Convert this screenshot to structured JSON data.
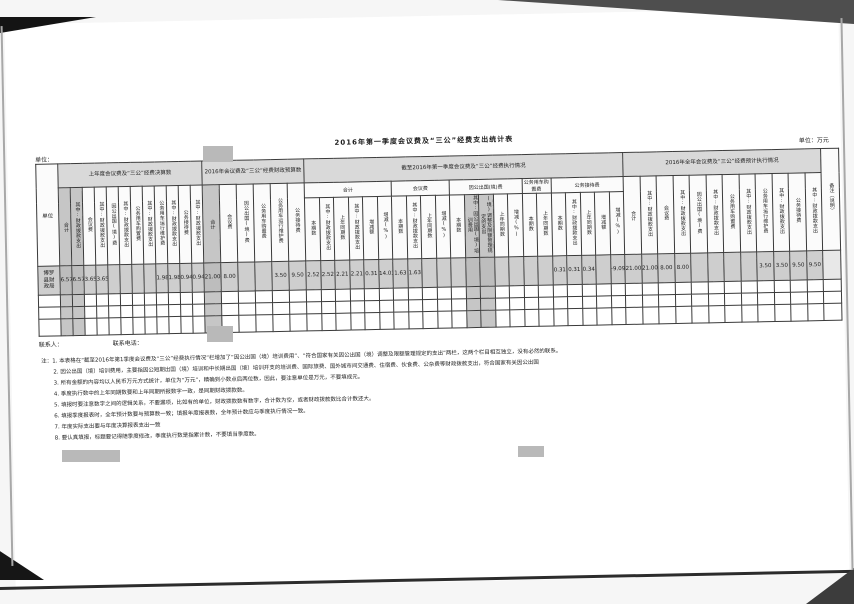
{
  "page": {
    "title": "2016年第一季度会议费及“三公”经费支出统计表",
    "unit_label": "单位：",
    "unit_of_measure": "单位：万元"
  },
  "table": {
    "unit_column_header": "单位",
    "remark_column_header": "备注（说明）",
    "row": {
      "unit_name": "博罗县财政局",
      "remark": ""
    },
    "groups": [
      {
        "title": "上年度会议费及“三公”经费决算数",
        "col_width": 12,
        "labels": [
          "合计",
          "其中:财政拨款支出",
          "会议费",
          "其中:财政拨款支出",
          "因公出国(境)费",
          "其中:财政拨款支出",
          "公务用车购置费",
          "其中:财政拨款支出",
          "公务用车运行维护费",
          "其中:财政拨款支出",
          "公务接待费",
          "其中:财政拨款支出"
        ],
        "shaded": [
          1,
          1,
          0,
          0,
          0,
          0,
          0,
          0,
          0,
          0,
          0,
          0
        ],
        "values": [
          "6.57",
          "6.57",
          "3.65",
          "3.65",
          "",
          "",
          "",
          "",
          "1.98",
          "1.98",
          "0.94",
          "0.94"
        ]
      },
      {
        "title": "2016年会议费及“三公”经费财政预算数",
        "col_width": 17,
        "labels": [
          "合计",
          "会议费",
          "因公出国(境)费",
          "公务用车购置费",
          "公务用车运行维护费",
          "公务接待费"
        ],
        "shaded": [
          1,
          0,
          0,
          0,
          0,
          0
        ],
        "values": [
          "21.00",
          "8.00",
          "",
          "",
          "3.50",
          "9.50"
        ]
      },
      {
        "title": "截至2016年第一季度会议费及“三公”经费执行情况",
        "col_width": 14.5,
        "categories": [
          {
            "label": "合计",
            "span": 6
          },
          {
            "label": "会议费",
            "span": 4
          },
          {
            "label": "因公出国(境)费",
            "span": 5
          },
          {
            "label": "公务用车购置费",
            "span": 2
          },
          {
            "label": "公务接待费",
            "span": 5
          }
        ],
        "labels": [
          "本期数",
          "其中:财政拨款支出",
          "上年同期数",
          "其中:财政拨款支出",
          "增减额",
          "增减(%)",
          "本期数",
          "其中:财政拨款支出",
          "上年同期数",
          "增减(%)",
          "本期数",
          "其中:因公出国(境)培训费用",
          "符合国家有关因公出国(境)调整及限额管理规定的支出",
          "上年同期数",
          "增减(%)",
          "本期数",
          "上年同期数",
          "本期数",
          "其中:财政拨款支出",
          "上年同期数",
          "增减额",
          "增减(%)"
        ],
        "shaded": [
          0,
          0,
          0,
          0,
          0,
          0,
          0,
          0,
          0,
          0,
          0,
          1,
          1,
          0,
          0,
          0,
          0,
          0,
          0,
          0,
          0,
          0
        ],
        "values": [
          "2.52",
          "2.52",
          "2.21",
          "2.21",
          "0.31",
          "14.03%",
          "1.63",
          "1.63",
          "",
          "",
          "",
          "",
          "",
          "",
          "",
          "",
          "",
          "0.31",
          "0.31",
          "0.34",
          "",
          "-9.09%"
        ]
      },
      {
        "title": "2016年全年会议费及“三公”经费预计执行情况",
        "col_width": 16.5,
        "labels": [
          "合计",
          "其中:财政拨款支出",
          "会议费",
          "其中:财政拨款支出",
          "因公出国(境)费",
          "其中:财政拨款支出",
          "公务用车购置费",
          "其中:财政拨款支出",
          "公务用车运行维护费",
          "其中:财政拨款支出",
          "公务接待费",
          "其中:财政拨款支出"
        ],
        "shaded": [
          0,
          0,
          0,
          0,
          0,
          0,
          0,
          0,
          0,
          0,
          0,
          0
        ],
        "values": [
          "21.00",
          "21.00",
          "8.00",
          "8.00",
          "",
          "",
          "",
          "",
          "3.50",
          "3.50",
          "9.50",
          "9.50"
        ]
      }
    ]
  },
  "contact": {
    "person_label": "联系人：",
    "phone_label": "联系电话："
  },
  "notes": [
    "注：1. 本表格在“截至2016年第1季度会议费及“三公”经费执行情况”栏增加了“因公出国（境）培训费用”、“符合国家有关因公出国（境）调整及限额管理规定的支出”两栏，这两个栏目相互独立，没有必然的联系。",
    "2. 因公出国（境）培训费用，主要指因公短期出国（境）培训和中长期出国（境）培训开支的培训费、国际旅费、国外城市间交通费、住宿费、伙食费、公杂费等财政拨款支出，符合国家有关因公出国",
    "3. 所有金额的内容均以人民币万元方式统计，单位为“万元”，精确到小数点后两位数，因此，要注意单位是万元，不要填成元。",
    "4. 季度执行数中的上年同期数要和上年同期所报数字一致，是同期财政拨款数。",
    "5. 填报时要注意数字之间的逻辑关系，不要漏项，比如有的单位，财政拨款数有数字，合计数为空，或者财政拨款数比合计数还大。",
    "6. 填报季度报表时，全年预计数要与预算数一致；填报年度报表数，全年预计数应与季度执行情况一致。",
    "7. 年度实际支出要与年度决算报表支出一致",
    "8. 要认真填报，标题要记得随季度修改，季度执行数是指累计数，不要填当季度数。"
  ]
}
